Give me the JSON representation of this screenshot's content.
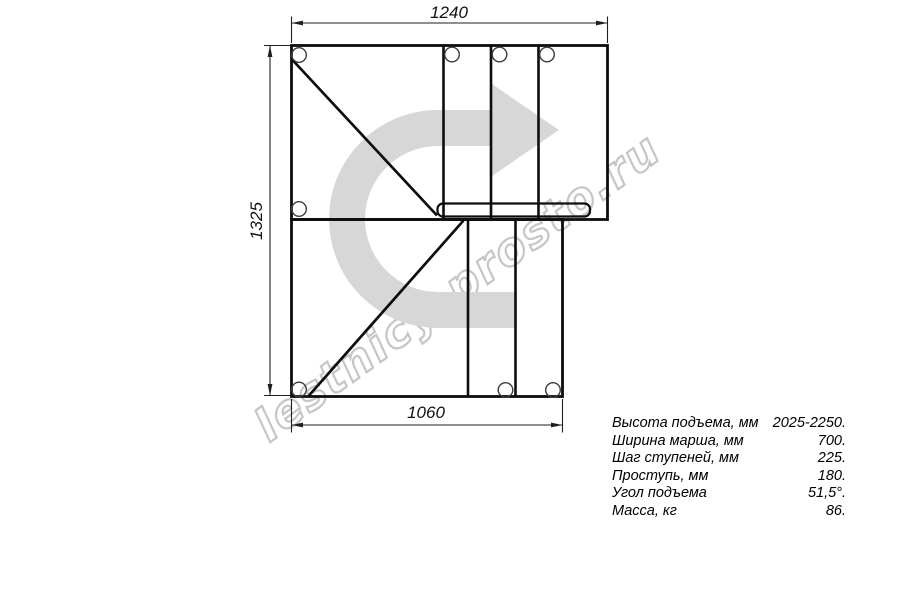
{
  "page": {
    "background": "#ffffff"
  },
  "drawing": {
    "dimensions": {
      "top_width_mm": "1240",
      "left_height_mm": "1325",
      "bottom_width_mm": "1060"
    }
  },
  "specs": {
    "rows": [
      {
        "label": "Высота подъема, мм",
        "value": "2025-2250."
      },
      {
        "label": "Ширина марша, мм",
        "value": "700."
      },
      {
        "label": "Шаг ступеней, мм",
        "value": "225."
      },
      {
        "label": "Проступь, мм",
        "value": "180."
      },
      {
        "label": "Угол подъема",
        "value": "51,5°."
      },
      {
        "label": "Масса, кг",
        "value": "86."
      }
    ]
  },
  "watermark": {
    "text": "lestnicy-prosto.ru",
    "arrow_color": "#d7d7d7",
    "text_outline_color": "#c6c6c6"
  },
  "colors": {
    "outline": "#0d0d0d",
    "dimension_line": "#1f1f1f",
    "hole_stroke": "#3c3c3c"
  }
}
